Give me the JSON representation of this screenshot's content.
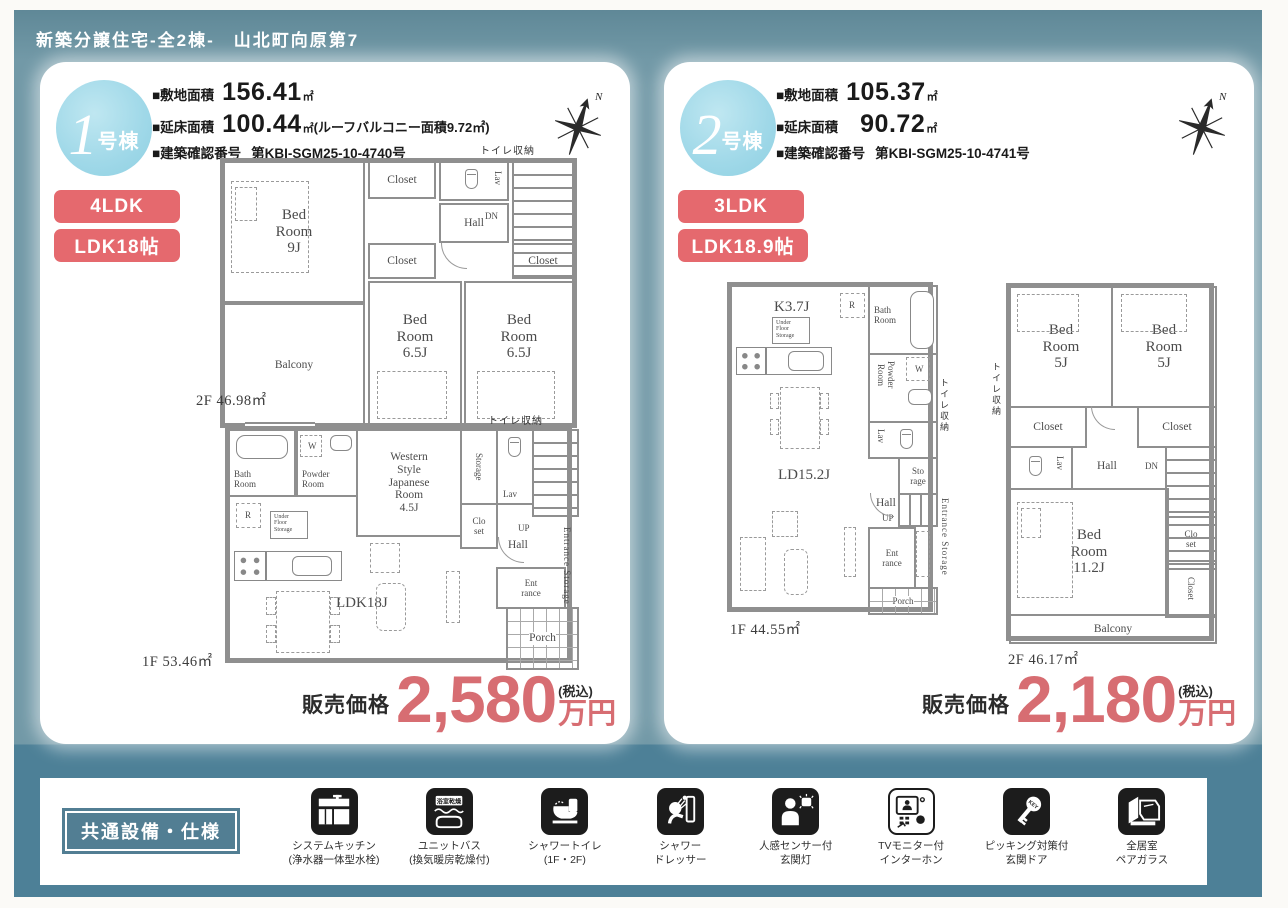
{
  "header": {
    "title": "新築分譲住宅-全2棟-　山北町向原第7"
  },
  "colors": {
    "frame_teal": "#7299a7",
    "frame_teal_dark": "#4d8097",
    "accent_red": "#e5696e",
    "price_red": "#d76d72",
    "badge_blue": "#9fd8e8",
    "wall_gray": "#8f8f8f"
  },
  "compass_label": "N",
  "buildings": [
    {
      "badge_number": "1",
      "badge_suffix": "号棟",
      "specs": [
        {
          "label": "■敷地面積",
          "value": "156.41",
          "unit": "㎡",
          "note": ""
        },
        {
          "label": "■延床面積",
          "value": "100.44",
          "unit": "㎡",
          "note": "(ルーフバルコニー面積9.72㎡)"
        },
        {
          "label": "■建築確認番号",
          "value": "第KBI-SGM25-10-4740号"
        }
      ],
      "tags": [
        {
          "label": "4LDK"
        },
        {
          "label": "LDK18帖"
        }
      ],
      "price": {
        "label": "販売価格",
        "amount": "2,580",
        "tax_note": "(税込)",
        "unit": "万円"
      },
      "floors": [
        {
          "area": "2F 46.98㎡",
          "annotation": "トイレ収納",
          "rooms": {
            "bed_main": "Bed\nRoom\n9J",
            "balcony": "Balcony",
            "closet_top": "Closet",
            "lav": "Lav",
            "hall": "Hall",
            "dn": "DN",
            "closet_mid": "Closet",
            "closet_right": "Closet",
            "bed_a": "Bed\nRoom\n6.5J",
            "bed_b": "Bed\nRoom\n6.5J"
          }
        },
        {
          "area": "1F 53.46㎡",
          "annotation": "トイレ収納",
          "rooms": {
            "bath": "Bath\nRoom",
            "powder": "Powder\nRoom",
            "washer": "W",
            "wsjr": "Western\nStyle\nJapanese\nRoom\n4.5J",
            "storage": "Storage",
            "lav": "Lav",
            "closet": "Clo\nset",
            "up": "UP",
            "hall": "Hall",
            "fridge": "R",
            "ufs": "Under\nFloor\nStorage",
            "ldk": "LDK18J",
            "entrance": "Ent\nrance",
            "entrance_storage": "Entrance Storage",
            "porch": "Porch"
          }
        }
      ]
    },
    {
      "badge_number": "2",
      "badge_suffix": "号棟",
      "specs": [
        {
          "label": "■敷地面積",
          "value": "105.37",
          "unit": "㎡",
          "note": ""
        },
        {
          "label": "■延床面積",
          "value": "90.72",
          "unit": "㎡",
          "note": ""
        },
        {
          "label": "■建築確認番号",
          "value": "第KBI-SGM25-10-4741号"
        }
      ],
      "tags": [
        {
          "label": "3LDK"
        },
        {
          "label": "LDK18.9帖"
        }
      ],
      "price": {
        "label": "販売価格",
        "amount": "2,180",
        "tax_note": "(税込)",
        "unit": "万円"
      },
      "floors": [
        {
          "area": "1F 44.55㎡",
          "annotation": "トイレ収納",
          "rooms": {
            "kitchen": "K3.7J",
            "fridge": "R",
            "ufs": "Under\nFloor\nStorage",
            "bath": "Bath\nRoom",
            "powder": "Powder\nRoom",
            "washer": "W",
            "lav": "Lav",
            "storage": "Sto\nrage",
            "hall": "Hall",
            "up": "UP",
            "ld": "LD15.2J",
            "entrance": "Ent\nrance",
            "entrance_storage": "Entrance Storage",
            "porch": "Porch"
          }
        },
        {
          "area": "2F 46.17㎡",
          "annotation": "トイレ収納",
          "rooms": {
            "bed_a": "Bed\nRoom\n5J",
            "bed_b": "Bed\nRoom\n5J",
            "closet_a": "Closet",
            "closet_b": "Closet",
            "lav": "Lav",
            "hall": "Hall",
            "dn": "DN",
            "bed_main": "Bed\nRoom\n11.2J",
            "closet_small": "Clo\nset",
            "closet_vert": "Closet",
            "balcony": "Balcony"
          }
        }
      ]
    }
  ],
  "footer": {
    "heading": "共通設備・仕様",
    "features": [
      {
        "name": "システムキッチン",
        "sub": "(浄水器一体型水栓)"
      },
      {
        "name": "ユニットバス",
        "sub": "(換気暖房乾燥付)",
        "icon_label": "浴室乾燥"
      },
      {
        "name": "シャワートイレ",
        "sub": "(1F・2F)"
      },
      {
        "name": "シャワー",
        "sub": "ドレッサー"
      },
      {
        "name": "人感センサー付",
        "sub": "玄関灯"
      },
      {
        "name": "TVモニター付",
        "sub": "インターホン"
      },
      {
        "name": "ピッキング対策付",
        "sub": "玄関ドア",
        "icon_label": "KEY"
      },
      {
        "name": "全居室",
        "sub": "ペアガラス"
      }
    ]
  }
}
